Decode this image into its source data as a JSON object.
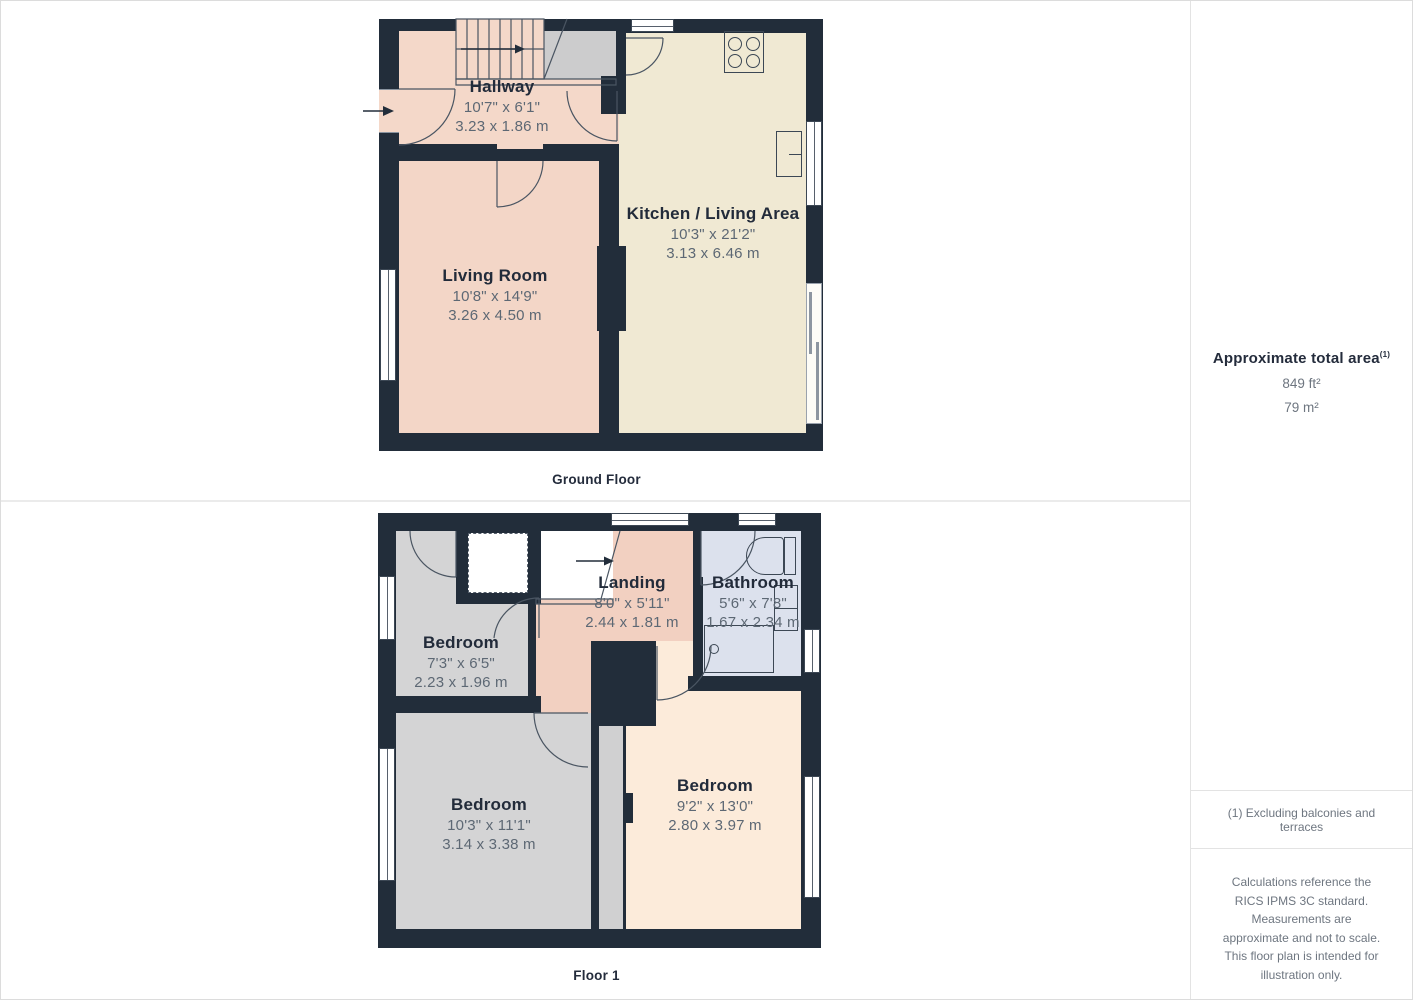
{
  "ground_floor": {
    "label": "Ground Floor",
    "rooms": {
      "hallway": {
        "name": "Hallway",
        "imperial": "10'7\" x 6'1\"",
        "metric": "3.23 x 1.86 m"
      },
      "living_room": {
        "name": "Living Room",
        "imperial": "10'8\" x 14'9\"",
        "metric": "3.26 x 4.50 m"
      },
      "kitchen": {
        "name": "Kitchen / Living Area",
        "imperial": "10'3\" x 21'2\"",
        "metric": "3.13 x 6.46 m"
      }
    }
  },
  "floor1": {
    "label": "Floor 1",
    "rooms": {
      "landing": {
        "name": "Landing",
        "imperial": "8'0\" x 5'11\"",
        "metric": "2.44 x 1.81 m"
      },
      "bathroom": {
        "name": "Bathroom",
        "imperial": "5'6\" x 7'8\"",
        "metric": "1.67 x 2.34 m"
      },
      "bedroom_small": {
        "name": "Bedroom",
        "imperial": "7'3\" x 6'5\"",
        "metric": "2.23 x 1.96 m"
      },
      "bedroom_left": {
        "name": "Bedroom",
        "imperial": "10'3\" x 11'1\"",
        "metric": "3.14 x 3.38 m"
      },
      "bedroom_right": {
        "name": "Bedroom",
        "imperial": "9'2\" x 13'0\"",
        "metric": "2.80 x 3.97 m"
      }
    }
  },
  "sidebar": {
    "total_area_title": "Approximate total area",
    "total_area_sup": "(1)",
    "area_ft": "849 ft²",
    "area_m": "79 m²",
    "footnote": "(1) Excluding balconies and terraces",
    "disclaimer": "Calculations reference the RICS IPMS 3C standard. Measurements are approximate and not to scale. This floor plan is intended for illustration only.",
    "brand": "GIRAFFE",
    "brand_suffix": "360"
  },
  "colors": {
    "wall": "#222d3a",
    "hallway": "#f4d8c9",
    "living_room": "#f3d6c7",
    "kitchen": "#f0e9d3",
    "landing": "#f2d0c1",
    "bathroom": "#dce1ed",
    "bedroom_gray": "#d4d4d5",
    "bedroom_peach": "#fcebda"
  }
}
